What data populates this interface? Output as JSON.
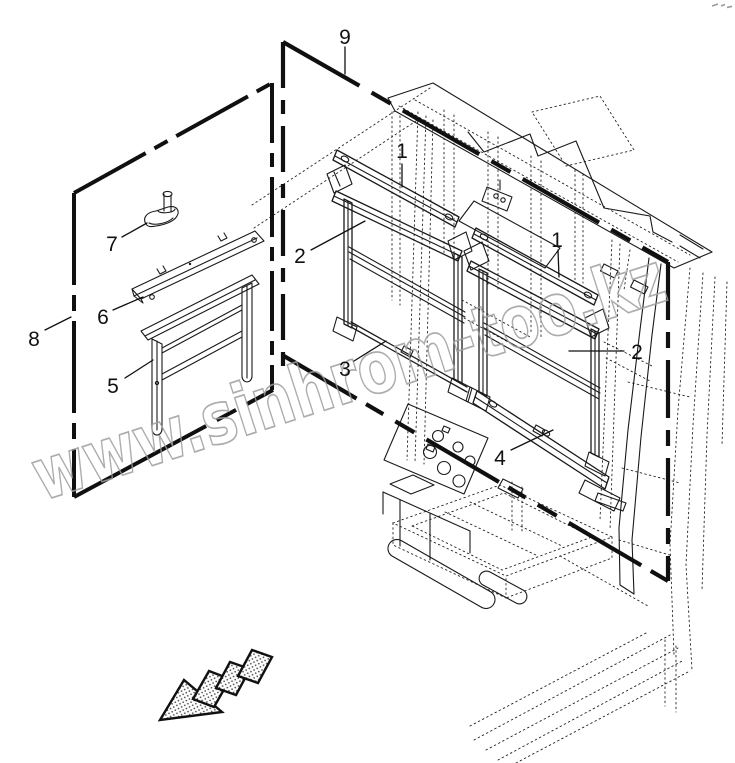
{
  "diagram": {
    "kind": "exploded-parts-line-diagram",
    "background": "#ffffff"
  },
  "watermark": {
    "text": "www.sinhrom-too.kz",
    "color": "#9e9e9e"
  },
  "callouts": [
    {
      "label": "1",
      "target": "left-curtain-mount-bar"
    },
    {
      "label": "1",
      "target": "right-curtain-mount-bar"
    },
    {
      "label": "2",
      "target": "left-curtain-frame"
    },
    {
      "label": "2",
      "target": "right-curtain-frame"
    },
    {
      "label": "3",
      "target": "left-curtain-lower-rod"
    },
    {
      "label": "4",
      "target": "right-curtain-lower-rail"
    },
    {
      "label": "5",
      "target": "detail-curtain-frame"
    },
    {
      "label": "6",
      "target": "detail-bracket-plate"
    },
    {
      "label": "7",
      "target": "detail-winder-knob"
    },
    {
      "label": "8",
      "target": "detail-view-boundary"
    },
    {
      "label": "9",
      "target": "window-seal-strip"
    }
  ],
  "colors": {
    "line": "#1a1a1a",
    "chain_line": "#101010",
    "watermark": "#9e9e9e",
    "callout_text": "#111111",
    "background": "#ffffff"
  },
  "icons": {
    "direction_arrow": "hatched-arrow-pointing-down-left",
    "corner_mark": "tiny-gray-print-artifact"
  }
}
